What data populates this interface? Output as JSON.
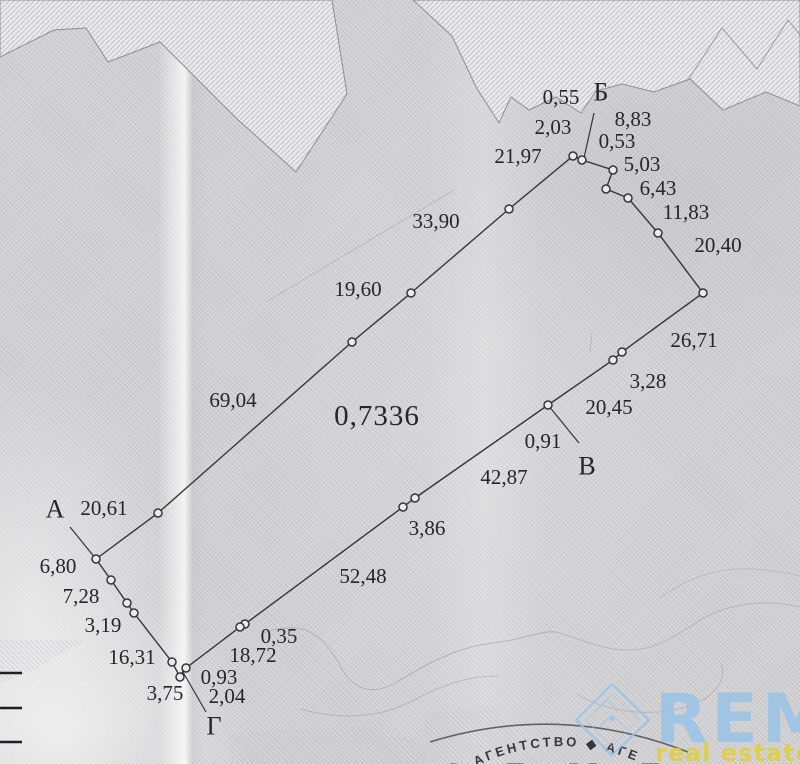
{
  "plan": {
    "area": {
      "text": "0,7336",
      "x": 377,
      "y": 416
    },
    "corner_labels": [
      {
        "id": "corner-a",
        "text": "А",
        "x": 55,
        "y": 509
      },
      {
        "id": "corner-b",
        "text": "Б",
        "x": 601,
        "y": 92
      },
      {
        "id": "corner-v",
        "text": "В",
        "x": 587,
        "y": 466
      },
      {
        "id": "corner-g",
        "text": "Г",
        "x": 214,
        "y": 726
      }
    ],
    "measurements": [
      {
        "text": "0,55",
        "x": 561,
        "y": 97
      },
      {
        "text": "2,03",
        "x": 553,
        "y": 127
      },
      {
        "text": "21,97",
        "x": 518,
        "y": 156
      },
      {
        "text": "8,83",
        "x": 633,
        "y": 119
      },
      {
        "text": "0,53",
        "x": 617,
        "y": 141
      },
      {
        "text": "5,03",
        "x": 642,
        "y": 164
      },
      {
        "text": "6,43",
        "x": 658,
        "y": 188
      },
      {
        "text": "11,83",
        "x": 686,
        "y": 212
      },
      {
        "text": "20,40",
        "x": 718,
        "y": 245
      },
      {
        "text": "33,90",
        "x": 436,
        "y": 221
      },
      {
        "text": "19,60",
        "x": 358,
        "y": 289
      },
      {
        "text": "26,71",
        "x": 694,
        "y": 340
      },
      {
        "text": "3,28",
        "x": 648,
        "y": 381
      },
      {
        "text": "20,45",
        "x": 609,
        "y": 407
      },
      {
        "text": "0,91",
        "x": 543,
        "y": 441
      },
      {
        "text": "69,04",
        "x": 233,
        "y": 400
      },
      {
        "text": "42,87",
        "x": 504,
        "y": 477
      },
      {
        "text": "3,86",
        "x": 427,
        "y": 528
      },
      {
        "text": "52,48",
        "x": 363,
        "y": 576
      },
      {
        "text": "20,61",
        "x": 104,
        "y": 508
      },
      {
        "text": "6,80",
        "x": 58,
        "y": 566
      },
      {
        "text": "7,28",
        "x": 81,
        "y": 596
      },
      {
        "text": "3,19",
        "x": 103,
        "y": 625
      },
      {
        "text": "16,31",
        "x": 132,
        "y": 657
      },
      {
        "text": "0,35",
        "x": 279,
        "y": 636
      },
      {
        "text": "18,72",
        "x": 253,
        "y": 655
      },
      {
        "text": "0,93",
        "x": 219,
        "y": 677
      },
      {
        "text": "2,04",
        "x": 227,
        "y": 696
      },
      {
        "text": "3,75",
        "x": 165,
        "y": 693
      }
    ],
    "boundary": [
      [
        96,
        559
      ],
      [
        158,
        513
      ],
      [
        352,
        342
      ],
      [
        411,
        293
      ],
      [
        509,
        209
      ],
      [
        573,
        156
      ],
      [
        582,
        160
      ],
      [
        613,
        170
      ],
      [
        606,
        189
      ],
      [
        628,
        198
      ],
      [
        658,
        233
      ],
      [
        703,
        293
      ],
      [
        622,
        352
      ],
      [
        613,
        360
      ],
      [
        548,
        405
      ],
      [
        415,
        498
      ],
      [
        403,
        507
      ],
      [
        245,
        624
      ],
      [
        240,
        627
      ],
      [
        186,
        668
      ],
      [
        183,
        671
      ],
      [
        180,
        677
      ],
      [
        172,
        662
      ],
      [
        134,
        613
      ],
      [
        127,
        603
      ],
      [
        111,
        580
      ]
    ],
    "vertex_markers": [
      [
        96,
        559
      ],
      [
        158,
        513
      ],
      [
        352,
        342
      ],
      [
        411,
        293
      ],
      [
        509,
        209
      ],
      [
        573,
        156
      ],
      [
        582,
        160
      ],
      [
        613,
        170
      ],
      [
        606,
        189
      ],
      [
        628,
        198
      ],
      [
        658,
        233
      ],
      [
        703,
        293
      ],
      [
        622,
        352
      ],
      [
        613,
        360
      ],
      [
        548,
        405
      ],
      [
        415,
        498
      ],
      [
        403,
        507
      ],
      [
        245,
        624
      ],
      [
        240,
        627
      ],
      [
        186,
        668
      ],
      [
        180,
        677
      ],
      [
        172,
        662
      ],
      [
        134,
        613
      ],
      [
        127,
        603
      ],
      [
        111,
        580
      ]
    ],
    "leader_lines": [
      [
        96,
        559,
        70,
        527
      ],
      [
        584,
        158,
        594,
        113
      ],
      [
        548,
        405,
        579,
        443
      ],
      [
        183,
        672,
        206,
        712
      ]
    ],
    "left_edge_ticks": [
      673,
      708,
      742
    ]
  },
  "stamp": {
    "ring_text": "АГЕНТСТВО ◆ АГЕ",
    "center_text": "З Е М Е"
  },
  "watermark": {
    "brand": "REM",
    "tagline": "real estate map"
  },
  "colors": {
    "paper": "#d6d6d8",
    "ink": "#26262a",
    "boundary_line": "#35353b",
    "zone_hatch": "#c6c6cb",
    "stamp_ink": "#2a2a30",
    "brand_blue": "#9cc6e9",
    "tagline_yellow": "#e4d13e"
  }
}
